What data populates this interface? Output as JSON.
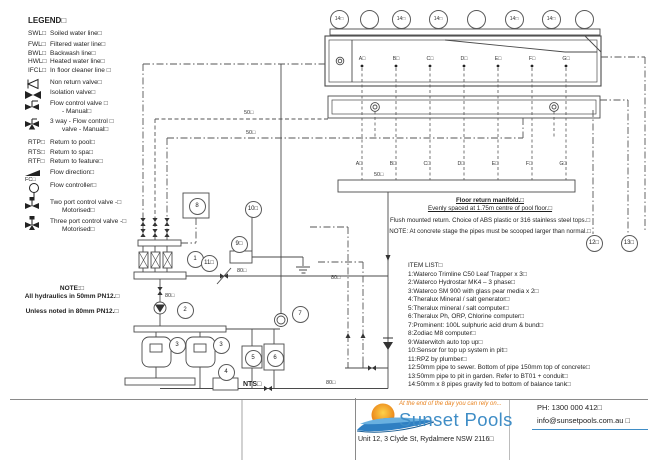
{
  "legend": {
    "title": "LEGEND□",
    "items": [
      {
        "abbr": "SWL□",
        "desc": "Soiled water line□"
      },
      {
        "abbr": "FWL□",
        "desc": "Filtered water line□"
      },
      {
        "abbr": "BWL□",
        "desc": "Backwash line□"
      },
      {
        "abbr": "HWL□",
        "desc": "Heated water line□"
      },
      {
        "abbr": "IFCL□",
        "desc": "In floor cleaner line □"
      },
      {
        "symbol": "non-return-valve",
        "desc": "Non return valve□"
      },
      {
        "symbol": "isolation-valve",
        "desc": "Isolation valve□"
      },
      {
        "symbol": "flow-control-valve-manual",
        "desc": "Flow control valve □",
        "desc2": "- Manual□"
      },
      {
        "symbol": "three-way-flow-control-valve",
        "desc": "3 way - Flow control □",
        "desc2": "valve - Manual□"
      },
      {
        "abbr": "RTP□",
        "desc": "Return to pool□"
      },
      {
        "abbr": "RTS□",
        "desc": "Return to spa□"
      },
      {
        "abbr": "RTF□",
        "desc": "Return to feature□"
      },
      {
        "symbol": "flow-direction",
        "desc": "Flow direction□"
      },
      {
        "symbol": "flow-controller",
        "abbr": "FC□",
        "desc": "Flow controller□"
      },
      {
        "symbol": "two-port-control-valve",
        "desc": "Two port control valve -□",
        "desc2": "Motorised□"
      },
      {
        "symbol": "three-port-control-valve",
        "desc": "Three port control valve -□",
        "desc2": "Motorised□"
      }
    ]
  },
  "note": {
    "title": "NOTE:□",
    "line1": "All hydraulics in 50mm PN12.□",
    "line2": "Unless noted in 80mm PN12.□"
  },
  "item_list": {
    "title": "ITEM LIST□",
    "items": [
      "1:Waterco Trimline C50 Leaf Trapper x 3□",
      "2:Waterco Hydrostar MK4 – 3 phase□",
      "3:Waterco SM 900 with glass pear media x 2□",
      "4:Theralux Mineral / salt generator□",
      "5:Theralux mineral / salt computer□",
      "6:Theralux Ph, ORP, Chlorine computer□",
      "7:Prominent: 100L sulphuric acid drum & bund□",
      "8:Zodiac M8 computer□",
      "9:Waterwitch auto top up□",
      "10:Sensor for top up system in pit□",
      "11:RPZ by plumber□",
      "12:50mm pipe to sewer. Bottom of pipe 150mm top of concrete□",
      "13:50mm pipe to pit in garden. Refer to BT01 + conduit□",
      "14:50mm x 8 pipes gravity fed to bottom of balance tank□"
    ]
  },
  "floor_note": {
    "line1": "Floor return manifold.□",
    "line2": "Evenly spaced at 1.75m centre of pool floor.□",
    "line3": "Flush mounted return. Choice of ABS plastic or 316 stainless steel tops.□",
    "line4": "NOTE: At concrete stage the pipes must be scooped larger than normal.□"
  },
  "pool": {
    "top_circle_labels": [
      "14□",
      "",
      "14□",
      "14□",
      "",
      "14□",
      "14□",
      ""
    ],
    "floor_letters": [
      "A□",
      "B□",
      "C□",
      "D□",
      "E□",
      "F□",
      "G□"
    ],
    "manifold_letters": [
      "A□",
      "B□",
      "C□",
      "D□",
      "E□",
      "F□",
      "G□"
    ]
  },
  "pipe_labels": {
    "line50_a": "50□",
    "line50_b": "50□",
    "manifold_50": "50□",
    "pump_80": "80□",
    "suction_80": "80□",
    "balance_80": "80□",
    "return_80": "80□"
  },
  "equipment_tags": {
    "t1": "1",
    "t2": "2",
    "t3a": "3",
    "t3b": "3",
    "t4": "4",
    "t5": "5",
    "t6": "6",
    "t7": "7",
    "t8": "8",
    "t9": "9□",
    "t10": "10□",
    "t11": "11□",
    "t12": "12□",
    "t13": "13□"
  },
  "nts": "NTS□",
  "footer": {
    "tagline": "At the end of the day you can rely on...",
    "brand": "Sunset Pools",
    "address": "Unit 12, 3 Clyde St, Rydalmere NSW 2116□",
    "phone": "PH: 1300 000 412□",
    "email": "info@sunsetpools.com.au □"
  },
  "colors": {
    "brand_blue": "#3f8dc6",
    "brand_orange": "#ed8b1e",
    "line": "#4a4a4a",
    "accent_rule": "#3f8dc6"
  }
}
